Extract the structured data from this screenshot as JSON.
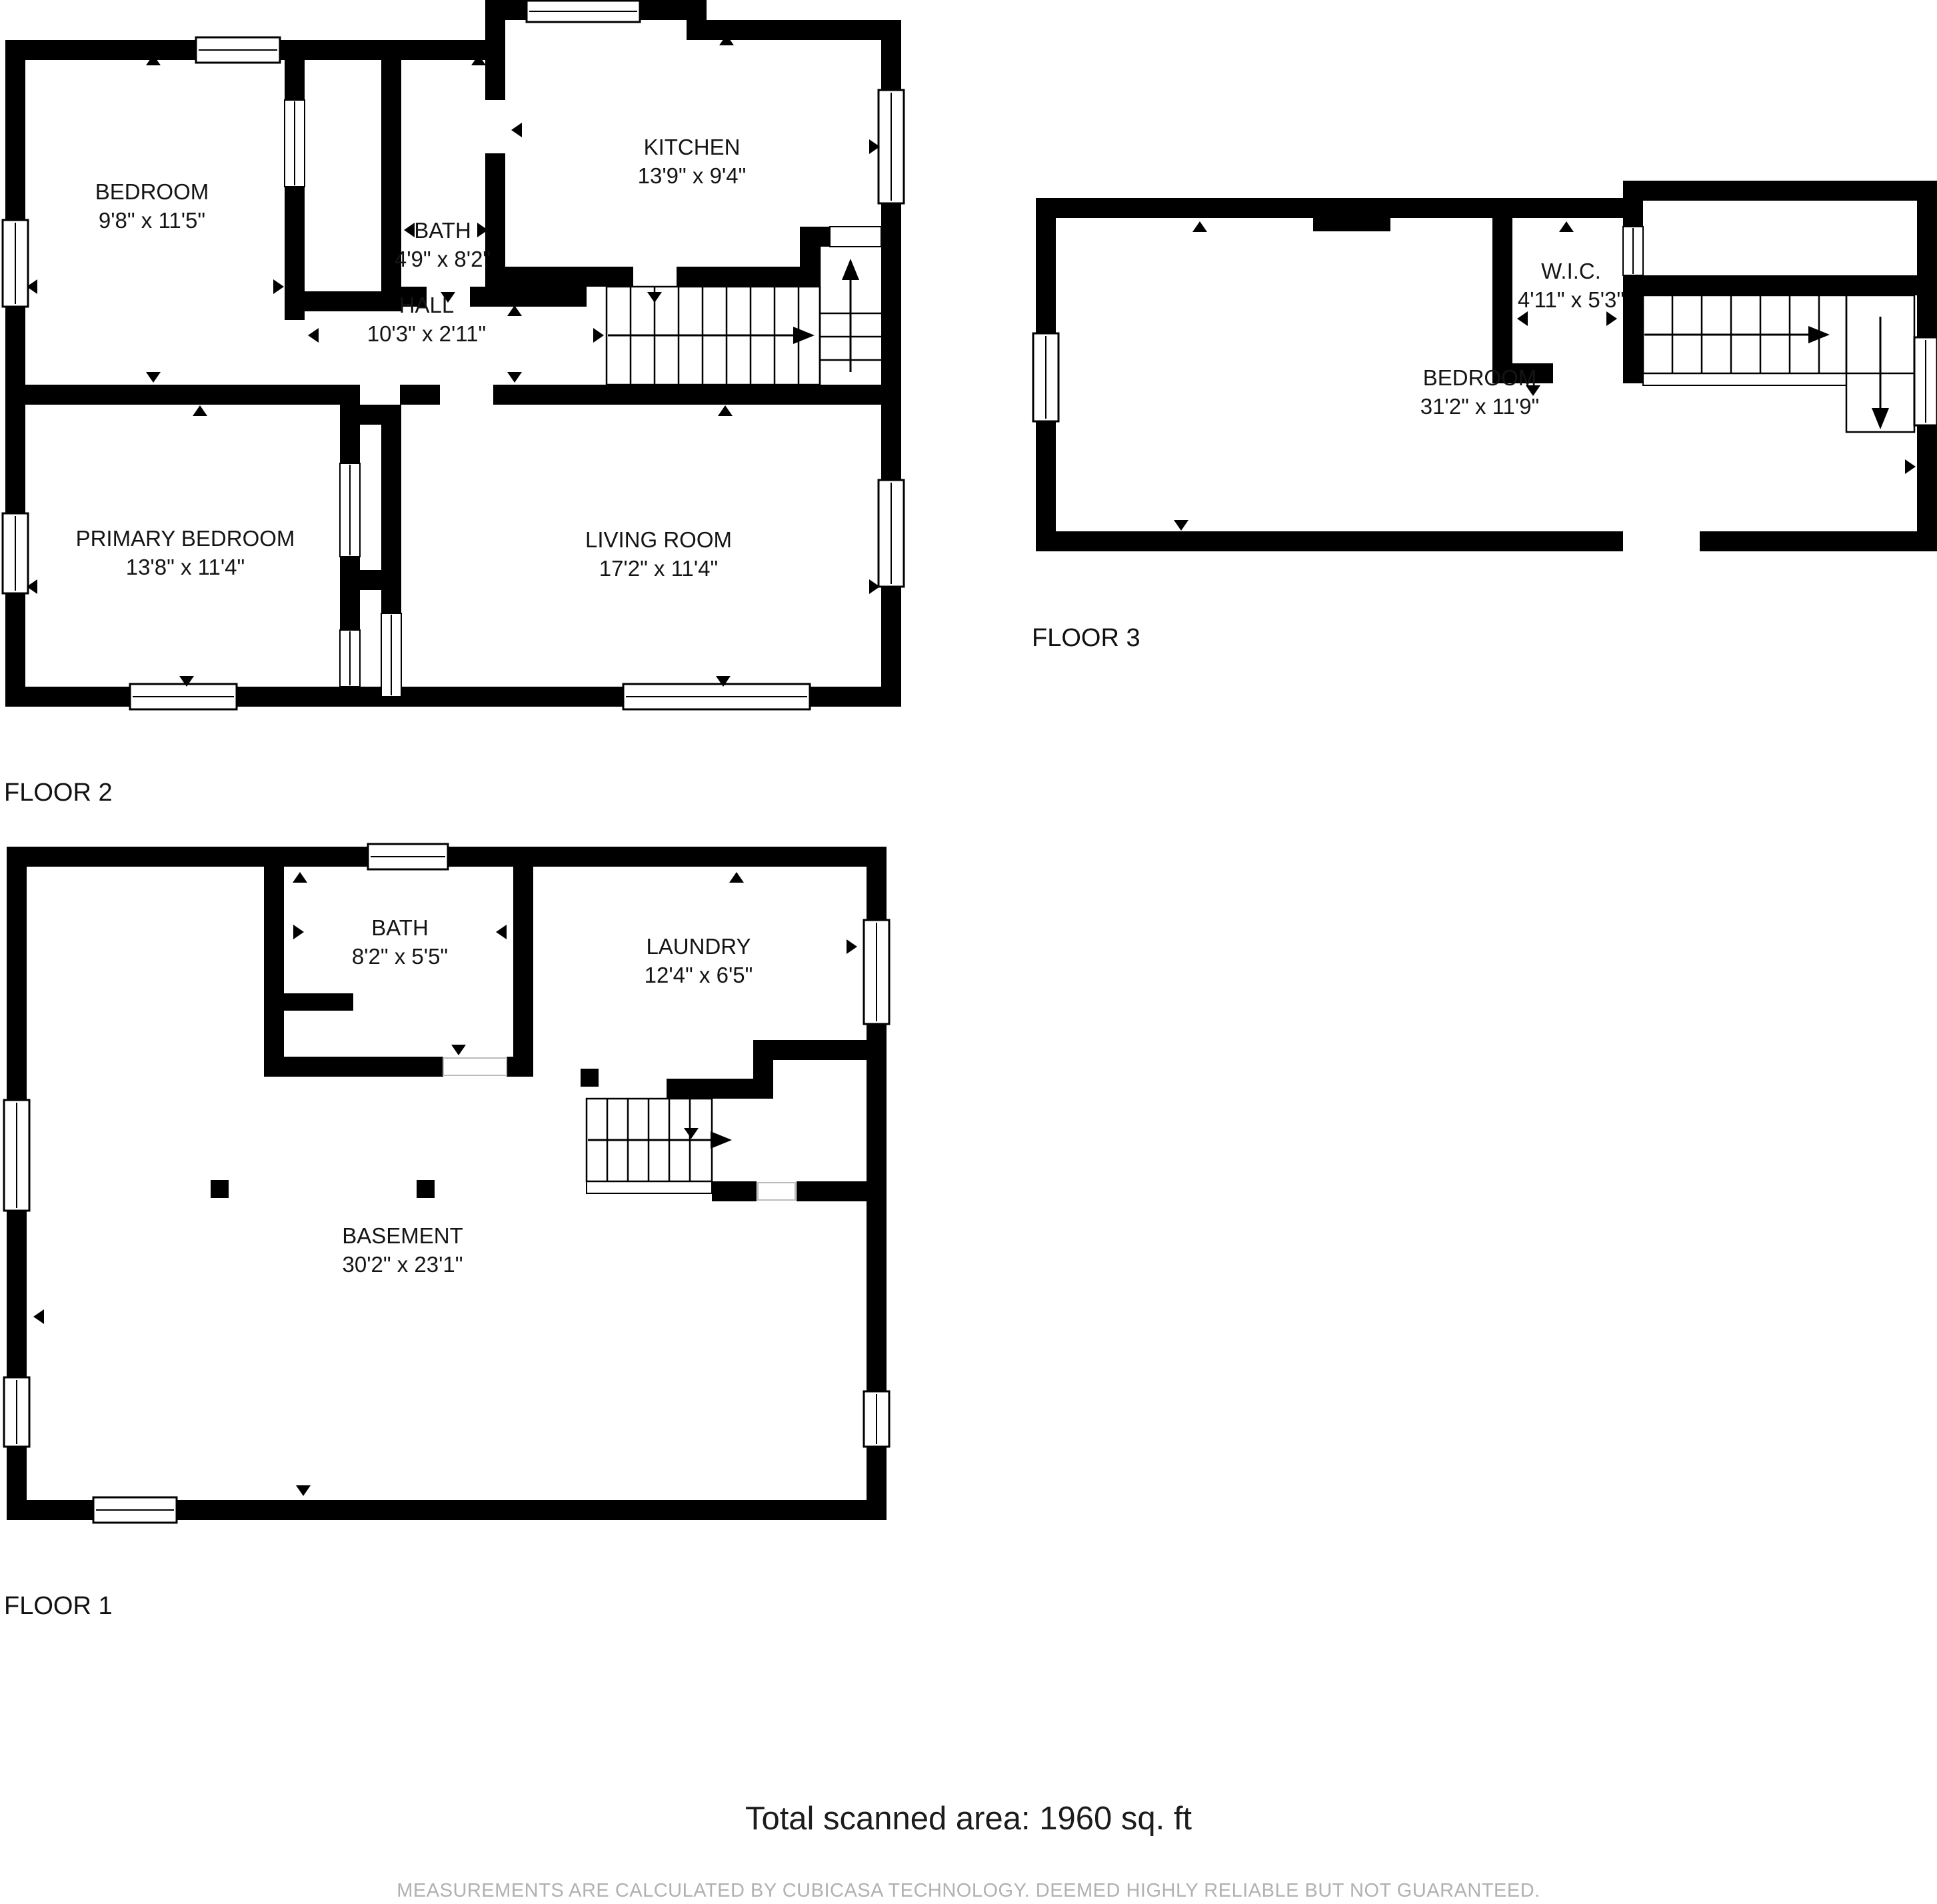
{
  "document": {
    "type": "floor-plan",
    "colors": {
      "wall": "#000000",
      "background": "#ffffff",
      "label_text": "#141414",
      "disclaimer_text": "#b1b1b1"
    }
  },
  "floors": [
    {
      "label": "FLOOR 2",
      "rooms": [
        {
          "name": "BEDROOM",
          "dims": "9'8\" x 11'5\""
        },
        {
          "name": "BATH",
          "dims": "4'9\" x 8'2\""
        },
        {
          "name": "KITCHEN",
          "dims": "13'9\" x 9'4\""
        },
        {
          "name": "HALL",
          "dims": "10'3\" x 2'11\""
        },
        {
          "name": "PRIMARY BEDROOM",
          "dims": "13'8\" x 11'4\""
        },
        {
          "name": "LIVING ROOM",
          "dims": "17'2\" x 11'4\""
        }
      ]
    },
    {
      "label": "FLOOR 3",
      "rooms": [
        {
          "name": "W.I.C.",
          "dims": "4'11\" x 5'3\""
        },
        {
          "name": "BEDROOM",
          "dims": "31'2\" x 11'9\""
        }
      ]
    },
    {
      "label": "FLOOR 1",
      "rooms": [
        {
          "name": "BATH",
          "dims": "8'2\" x 5'5\""
        },
        {
          "name": "LAUNDRY",
          "dims": "12'4\" x 6'5\""
        },
        {
          "name": "BASEMENT",
          "dims": "30'2\" x 23'1\""
        }
      ]
    }
  ],
  "footer": {
    "total_area": "Total scanned area: 1960 sq. ft",
    "disclaimer": "MEASUREMENTS ARE CALCULATED BY CUBICASA TECHNOLOGY. DEEMED HIGHLY RELIABLE BUT NOT GUARANTEED."
  }
}
